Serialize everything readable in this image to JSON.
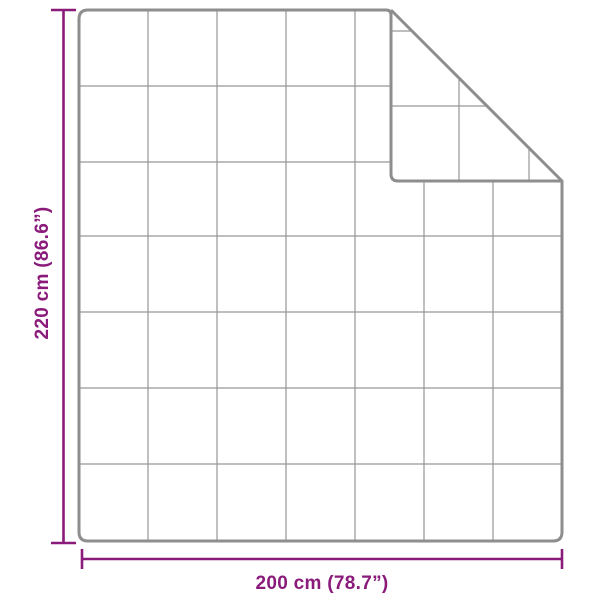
{
  "diagram": {
    "height_label": "220 cm (86.6”)",
    "width_label": "200 cm (78.7”)",
    "height": {
      "cm": "220",
      "inches": "86.6"
    },
    "width": {
      "cm": "200",
      "inches": "78.7"
    },
    "grid": {
      "rows": 7,
      "columns": 7,
      "folded_corner": "top-right"
    },
    "colors": {
      "dimension_lines": "#8a1b7a",
      "outline": "#8e8e8e",
      "grid_lines": "#979797",
      "background": "#ffffff"
    }
  }
}
